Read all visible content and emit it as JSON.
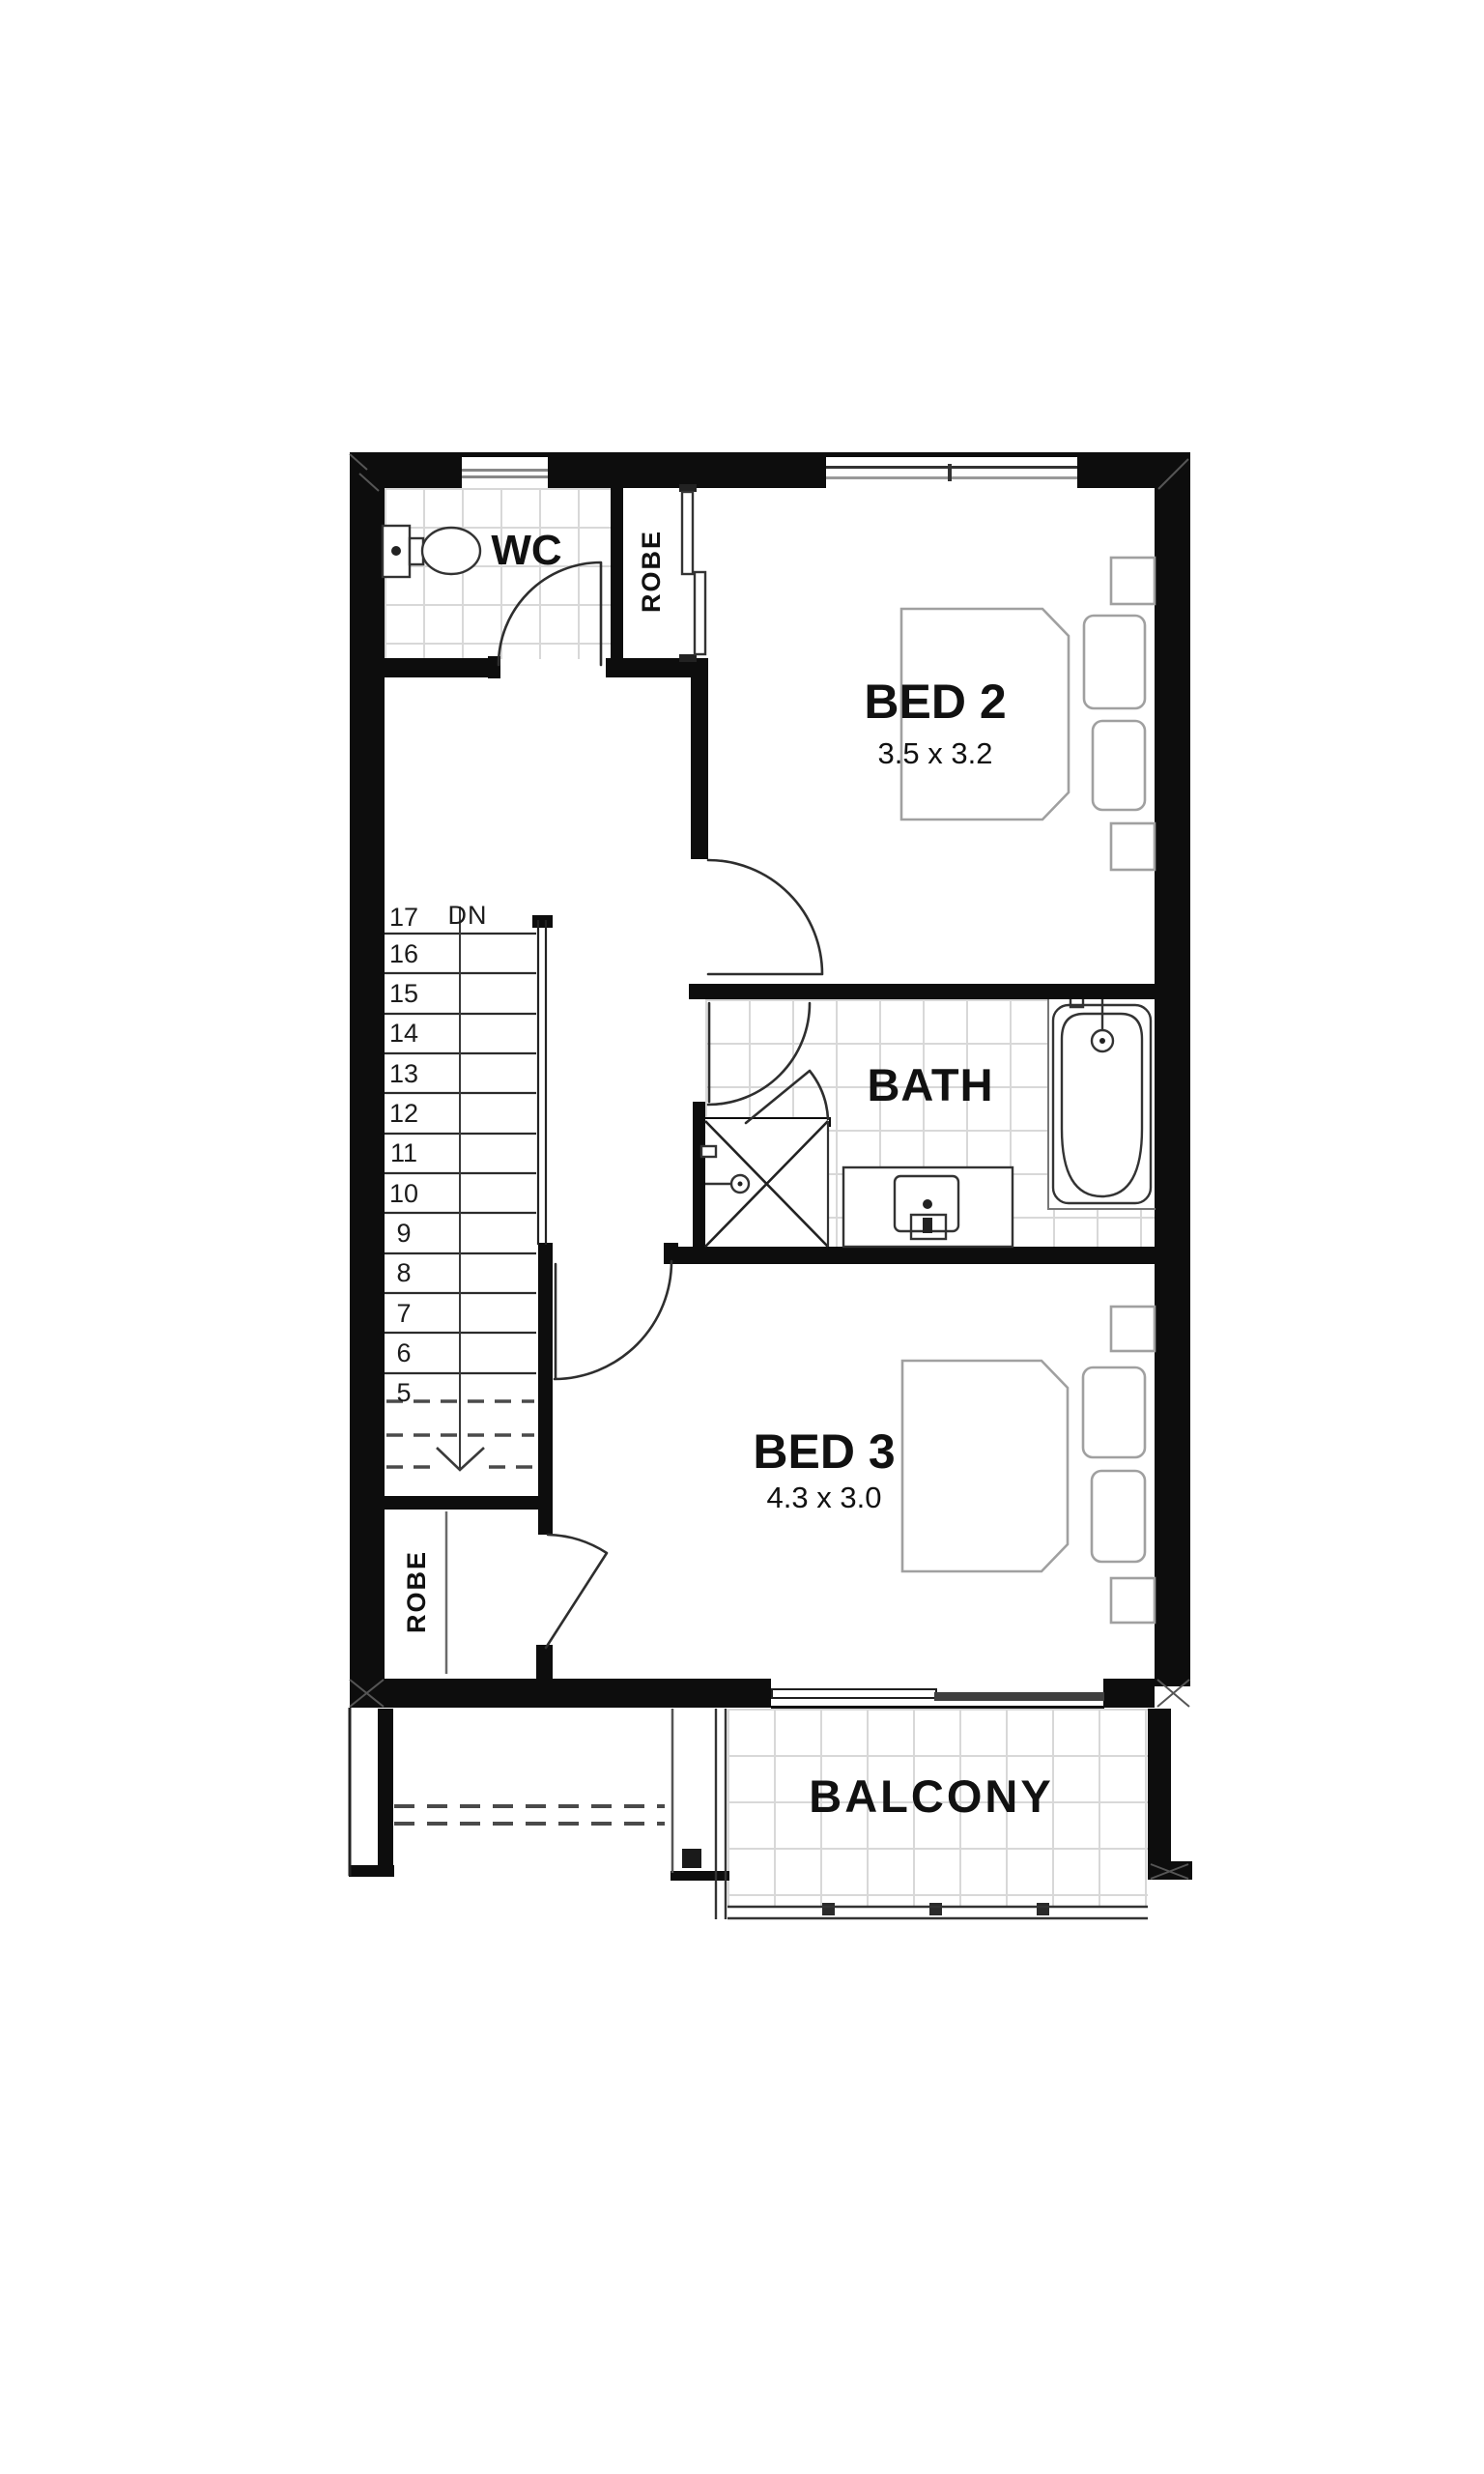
{
  "floor_plan": {
    "rooms": {
      "wc": {
        "label": "WC"
      },
      "robe_upper": {
        "label": "ROBE"
      },
      "bed2": {
        "label": "BED 2",
        "dimensions": "3.5 x 3.2"
      },
      "bath": {
        "label": "BATH"
      },
      "bed3": {
        "label": "BED 3",
        "dimensions": "4.3 x 3.0"
      },
      "robe_lower": {
        "label": "ROBE"
      },
      "balcony": {
        "label": "BALCONY"
      }
    },
    "stairs": {
      "top_step_number": "17",
      "direction_label": "DN",
      "step_numbers": [
        "16",
        "15",
        "14",
        "13",
        "12",
        "11",
        "10",
        "9",
        "8",
        "7",
        "6",
        "5"
      ]
    },
    "colors": {
      "wall": "#0d0d0d",
      "door_line": "#2e2e2e",
      "fixture_line": "#333333",
      "furniture_line": "#a0a0a0",
      "tile_line": "#d8d8d8",
      "text": "#111111"
    }
  }
}
